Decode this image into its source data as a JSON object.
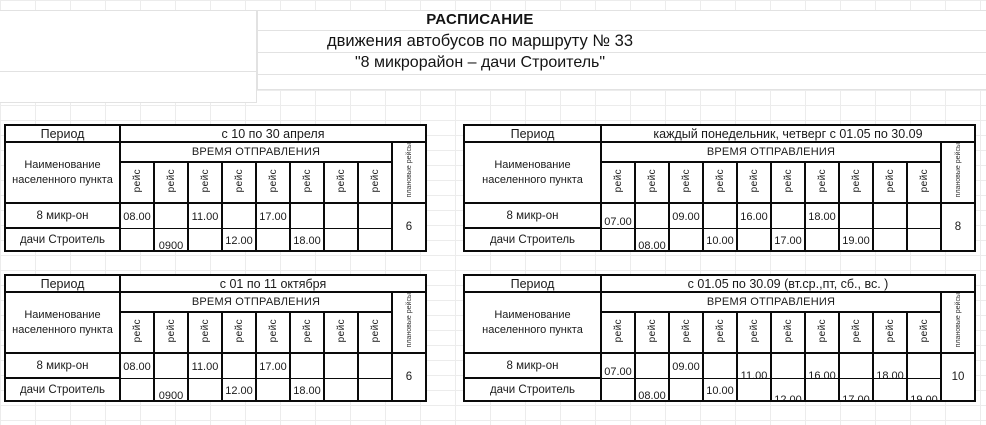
{
  "title": {
    "line1": "РАСПИСАНИЕ",
    "line2": "движения автобусов по маршруту № 33",
    "line3": "\"8 микрорайон – дачи Строитель\""
  },
  "labels": {
    "period_label": "Период",
    "settlement_label": "Наименование населенного пункта",
    "departure_label": "ВРЕМЯ ОТПРАВЛЕНИЯ",
    "trip_label": "рейс",
    "planned_label": "плановые рейсы"
  },
  "stops": [
    "8 микр-он",
    "дачи Строитель"
  ],
  "tables": [
    {
      "period": "с 10 по 30 апреля",
      "columns": 8,
      "planned": "6",
      "cells": [
        [
          "08.00",
          "",
          "11.00",
          "",
          "17.00",
          "",
          "",
          ""
        ],
        [
          "",
          "0900",
          "",
          "12.00",
          "",
          "18.00",
          "",
          ""
        ]
      ],
      "offsets": [
        [
          0,
          0,
          0,
          0,
          0,
          0,
          0,
          0
        ],
        [
          0,
          1,
          0,
          0,
          0,
          0,
          0,
          0
        ]
      ]
    },
    {
      "period": "каждый понедельник, четверг с 01.05 по 30.09",
      "columns": 10,
      "planned": "8",
      "cells": [
        [
          "07.00",
          "",
          "09.00",
          "",
          "16.00",
          "",
          "18.00",
          "",
          "",
          ""
        ],
        [
          "",
          "08.00",
          "",
          "10.00",
          "",
          "17.00",
          "",
          "19.00",
          "",
          ""
        ]
      ],
      "offsets": [
        [
          1,
          0,
          0,
          0,
          0,
          0,
          0,
          0,
          0,
          0
        ],
        [
          0,
          1,
          0,
          0,
          0,
          0,
          0,
          0,
          0,
          0
        ]
      ]
    },
    {
      "period": "с 01 по 11 октября",
      "columns": 8,
      "planned": "6",
      "cells": [
        [
          "08.00",
          "",
          "11.00",
          "",
          "17.00",
          "",
          "",
          ""
        ],
        [
          "",
          "0900",
          "",
          "12.00",
          "",
          "18.00",
          "",
          ""
        ]
      ],
      "offsets": [
        [
          0,
          0,
          0,
          0,
          0,
          0,
          0,
          0
        ],
        [
          0,
          1,
          0,
          0,
          0,
          0,
          0,
          0
        ]
      ]
    },
    {
      "period": "с 01.05 по 30.09 (вт.ср.,пт, сб., вс. )",
      "columns": 10,
      "planned": "10",
      "cells": [
        [
          "07.00",
          "",
          "09.00",
          "",
          "11.00",
          "",
          "16.00",
          "",
          "18.00",
          ""
        ],
        [
          "",
          "08.00",
          "",
          "10.00",
          "",
          "12.00",
          "",
          "17.00",
          "",
          "19.00"
        ]
      ],
      "offsets": [
        [
          1,
          0,
          0,
          0,
          2,
          0,
          2,
          0,
          2,
          0
        ],
        [
          0,
          1,
          0,
          0,
          0,
          2,
          0,
          2,
          0,
          2
        ]
      ]
    }
  ],
  "colors": {
    "table_border": "#0a0a0a",
    "grid_line": "#ececec",
    "text": "#1a1a1a"
  }
}
